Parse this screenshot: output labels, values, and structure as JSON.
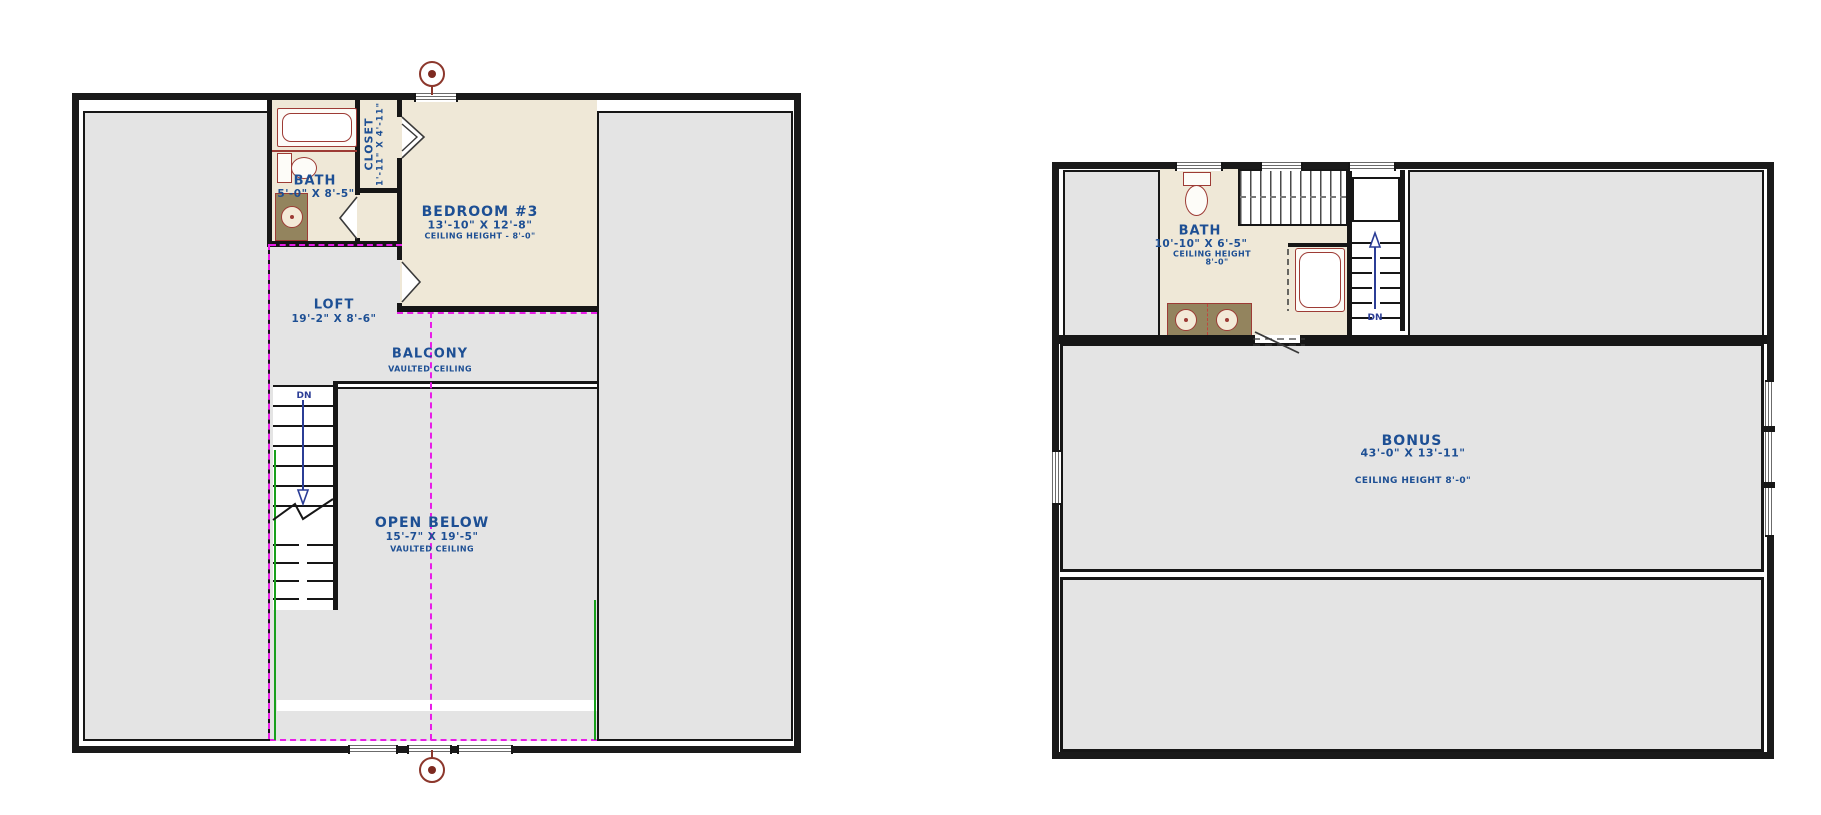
{
  "document": {
    "type": "floor-plan-drawing",
    "sheets": [
      "upper-floor-plan",
      "bonus-floor-plan"
    ]
  },
  "left_plan": {
    "bath_label": "BATH",
    "bath_dims": "5'-0\" X 8'-5\"",
    "closet_label": "CLOSET",
    "closet_dims": "1'-11\" X 4'-11\"",
    "bedroom_label": "BEDROOM #3",
    "bedroom_dims": "13'-10\" X 12'-8\"",
    "bedroom_ceiling": "CEILING HEIGHT - 8'-0\"",
    "loft_label": "LOFT",
    "loft_dims": "19'-2\" X 8'-6\"",
    "balcony_label": "BALCONY",
    "balcony_note": "VAULTED CEILING",
    "open_below_label": "OPEN BELOW",
    "open_below_dims": "15'-7\" X 19'-5\"",
    "open_below_note": "VAULTED CEILING",
    "stairs_dn": "DN"
  },
  "right_plan": {
    "bath_label": "BATH",
    "bath_dims": "10'-10\" X 6'-5\"",
    "bath_ceiling_line1": "CEILING HEIGHT",
    "bath_ceiling_line2": "8'-0\"",
    "bonus_label": "BONUS",
    "bonus_dims": "43'-0\" X 13'-11\"",
    "bonus_ceiling": "CEILING HEIGHT 8'-0\"",
    "stairs_dn": "DN"
  },
  "colors": {
    "wall": "#161616",
    "floor_gray": "#e4e4e4",
    "floor_beige": "#efe8d7",
    "label_blue": "#1d4f94",
    "fixture_red": "#9d3b35",
    "vanity_brown": "#93845e",
    "overlay_magenta": "#e81ce8",
    "stair_arrow_blue": "#2b3d96",
    "accent_green": "#18a01c"
  }
}
